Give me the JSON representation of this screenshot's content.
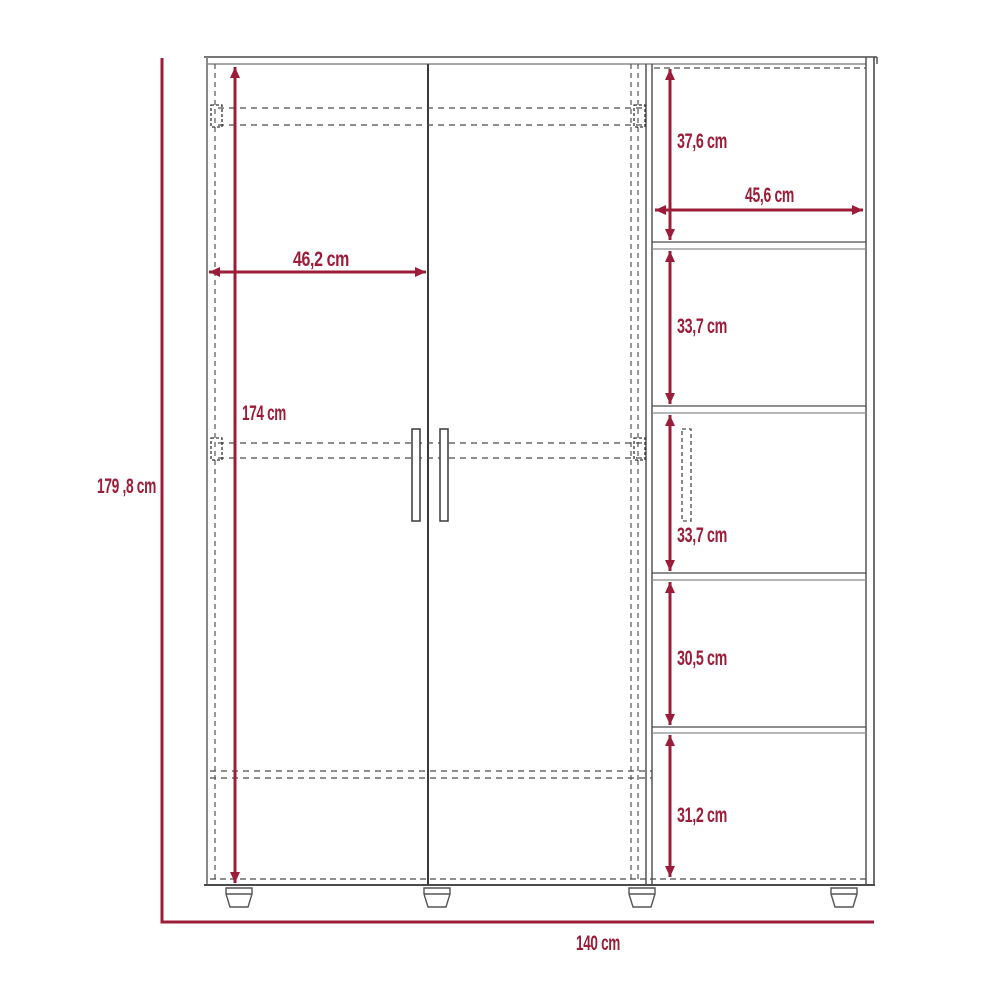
{
  "meta": {
    "type": "furniture dimension diagram",
    "subject": "wardrobe with two hinged doors and right-hand shelf column on feet"
  },
  "colors": {
    "dimension_accent": "#9C1D39",
    "outline_dark": "#4A4A4A",
    "outline_light": "#8A8A8A",
    "background": "#FFFFFF"
  },
  "dimensions": {
    "overall_height": "179 ,8 cm",
    "overall_width": "140 cm",
    "door_height": "174 cm",
    "door_width": "46,2 cm",
    "shelf_width": "45,6 cm",
    "section_1": "37,6 cm",
    "section_2": "33,7 cm",
    "section_3": "33,7 cm",
    "section_4": "30,5 cm",
    "section_5": "31,2 cm"
  }
}
